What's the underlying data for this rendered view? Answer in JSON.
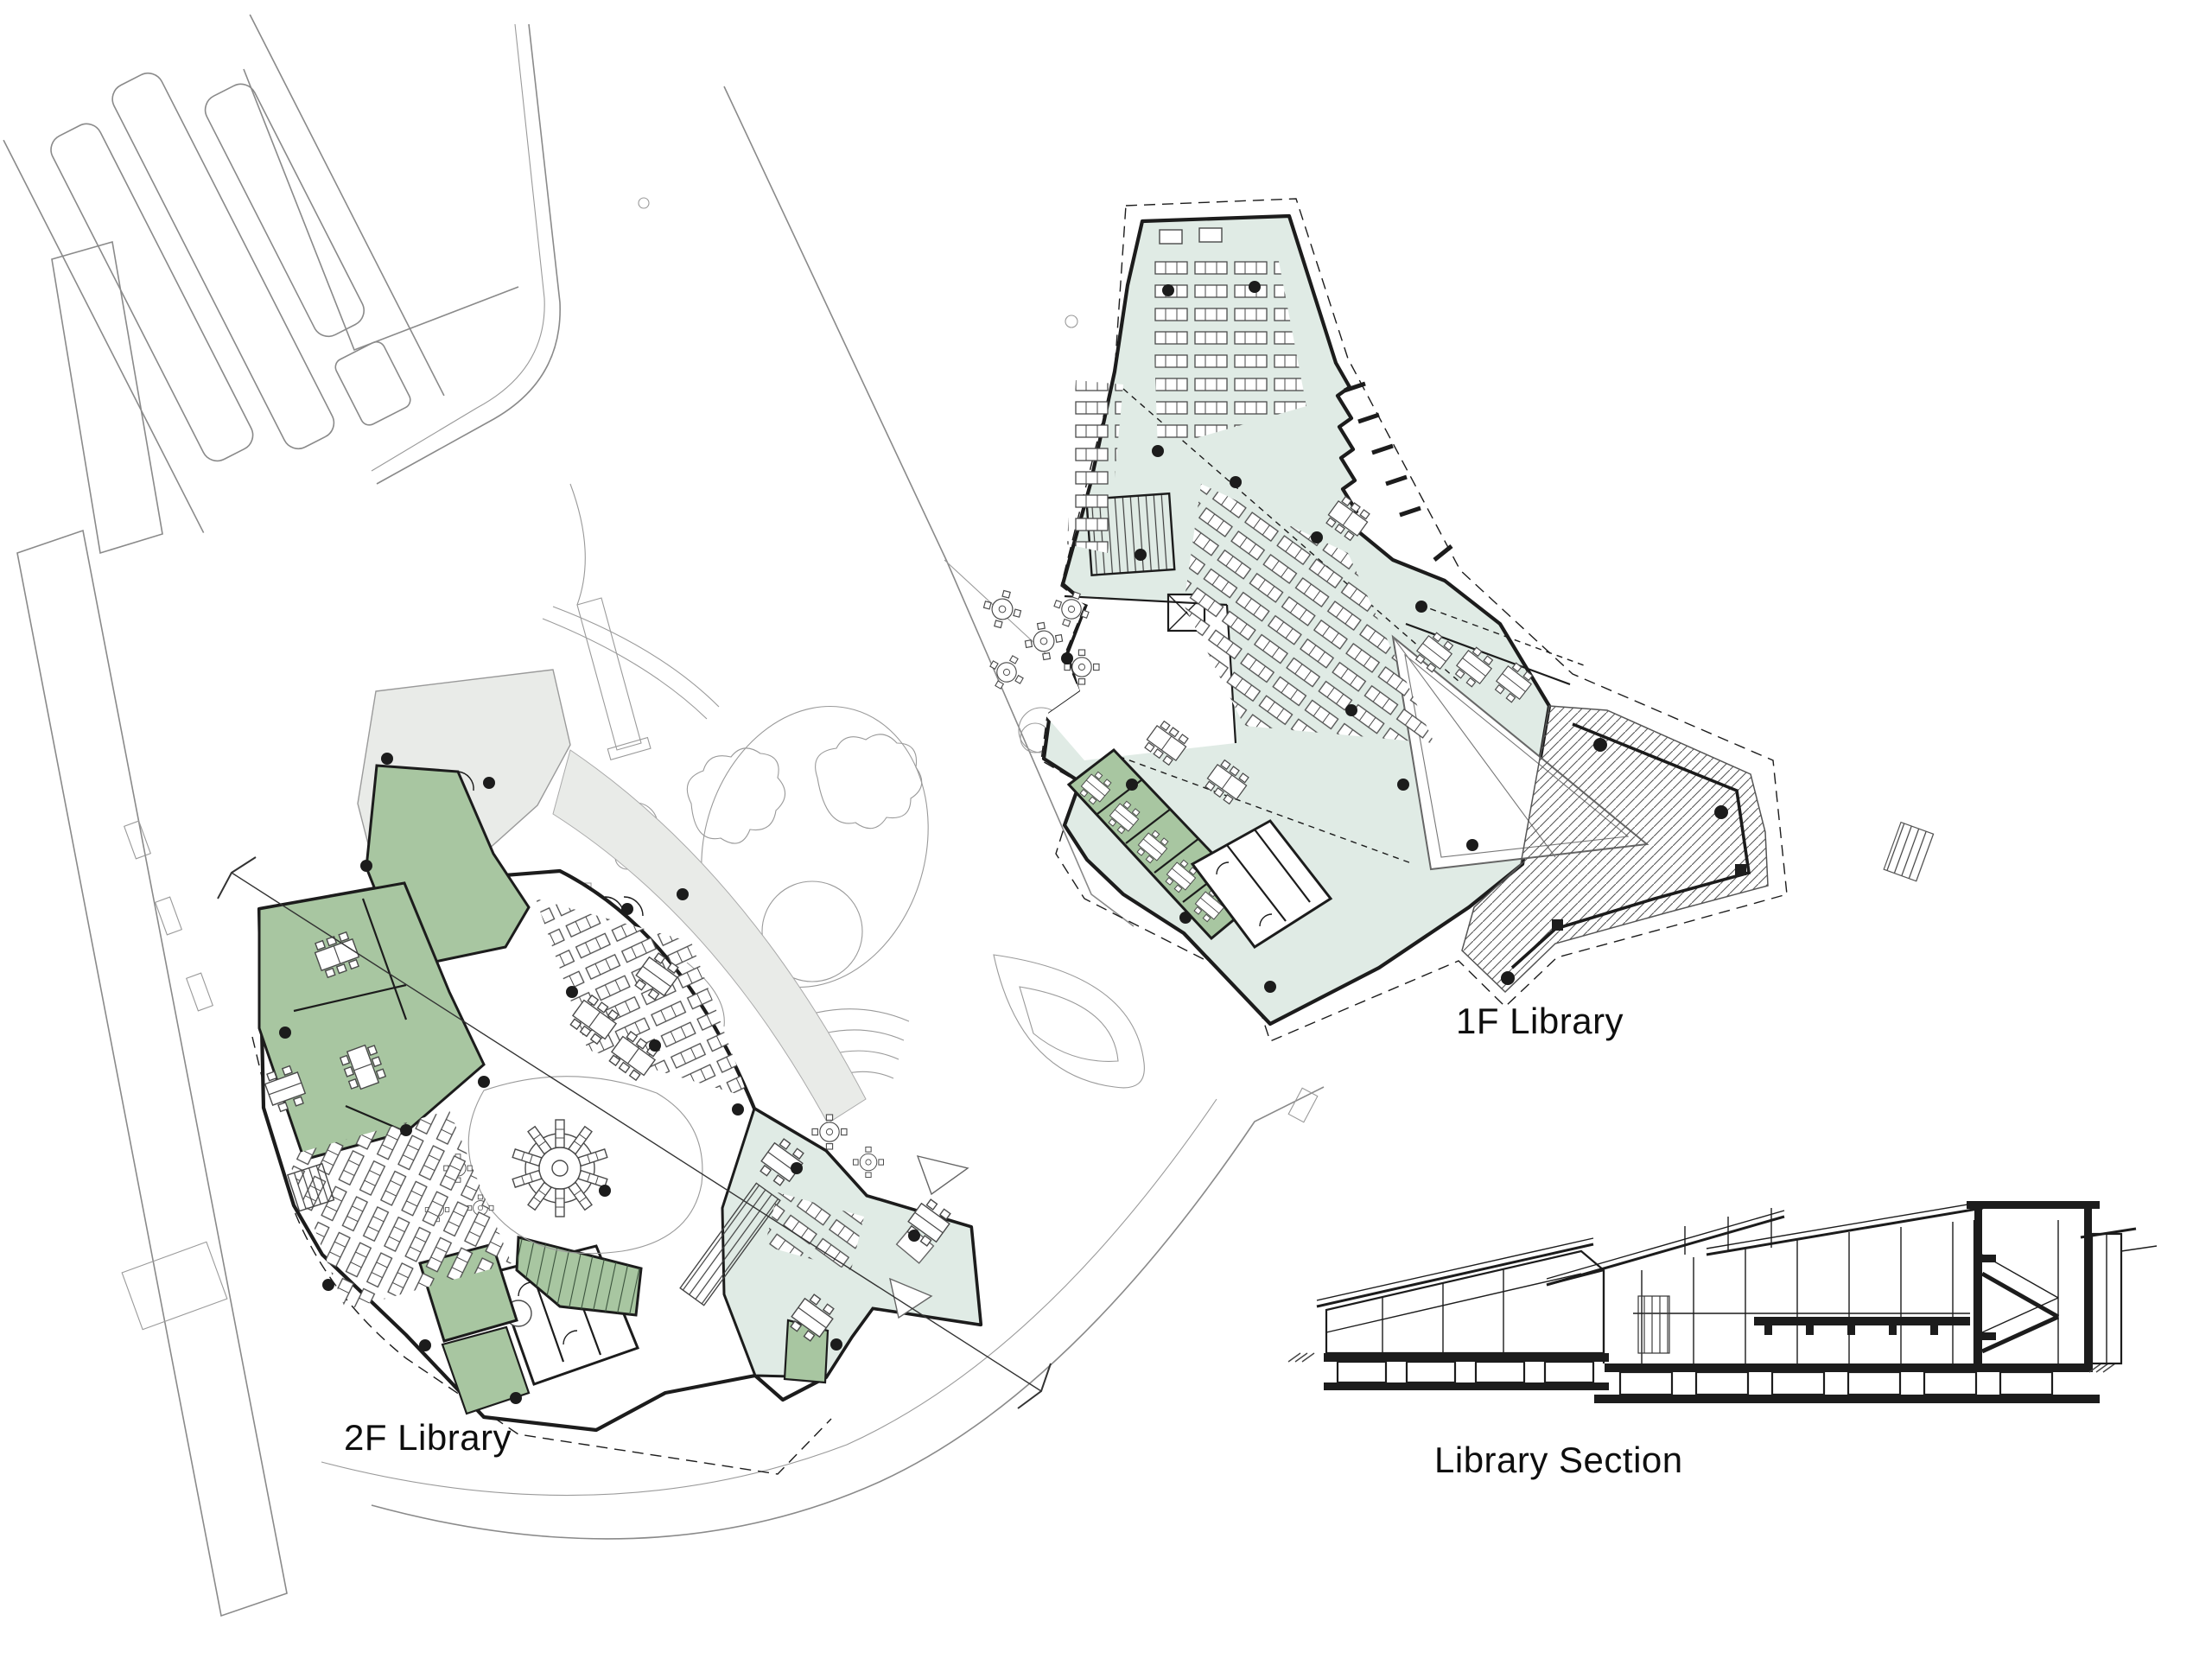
{
  "page": {
    "title": "Library drawing sheet",
    "background": "#ffffff"
  },
  "drawings": [
    {
      "id": "plan-1f",
      "label": "1F Library"
    },
    {
      "id": "plan-2f",
      "label": "2F Library"
    },
    {
      "id": "section",
      "label": "Library Section"
    }
  ],
  "theme": {
    "room-green": "#a8c6a1",
    "reading-mint": "#e0ebe5",
    "terrace-gray": "#e9ebe8",
    "ink": "#1c1c1c",
    "site-line": "#8a8a8a",
    "hatch-line": "#555555"
  }
}
